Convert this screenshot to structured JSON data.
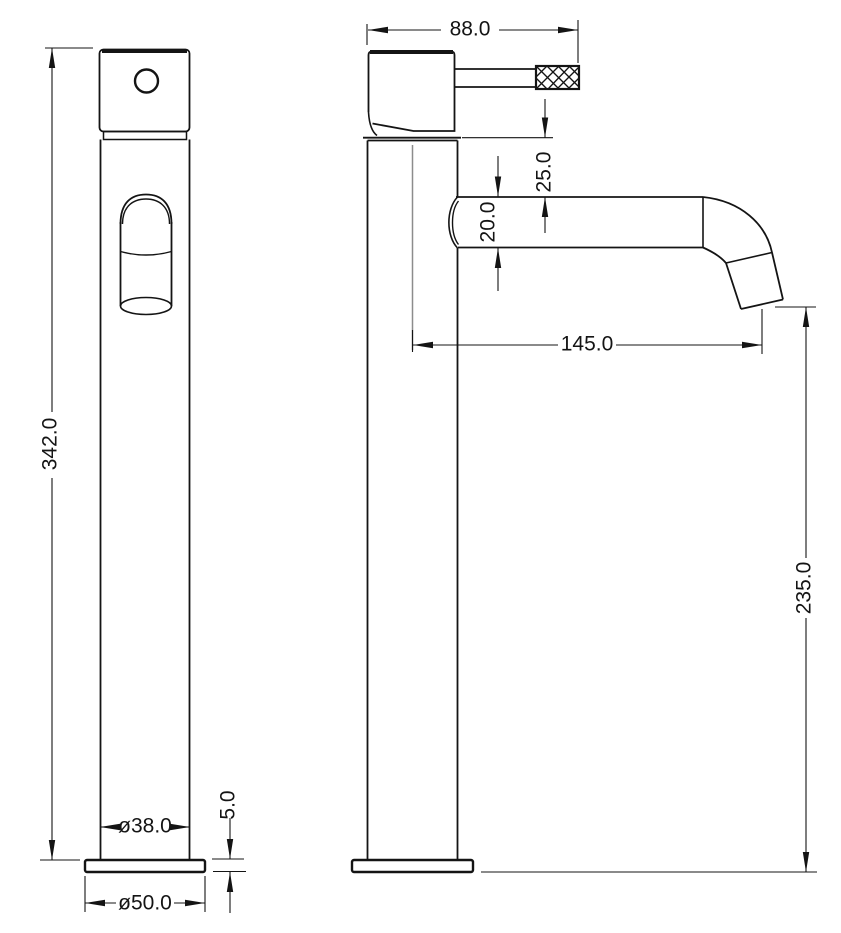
{
  "page": {
    "background": "#ffffff",
    "line_color": "#141414",
    "centerline_color": "#8c8c8c"
  },
  "drawing": {
    "dimensions": {
      "overall_height": "342.0",
      "body_diameter": "ø38.0",
      "base_plate_height": "5.0",
      "base_plate_diameter": "ø50.0",
      "head_depth": "88.0",
      "body_to_spout_gap": "25.0",
      "spout_tube_diameter": "20.0",
      "spout_reach": "145.0",
      "spout_outlet_height": "235.0"
    }
  }
}
